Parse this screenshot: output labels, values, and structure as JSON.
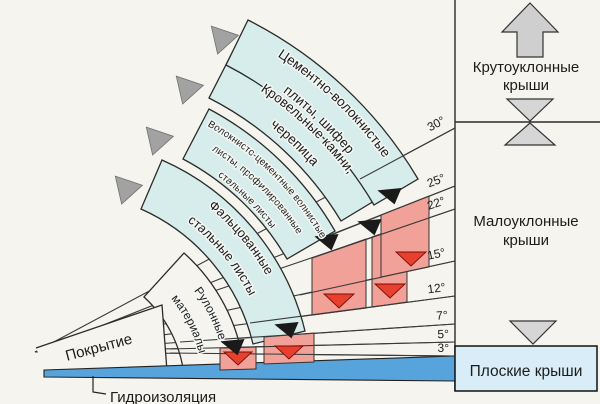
{
  "diagram_title": "Roof slope ranges by roofing material",
  "bands": {
    "cement_fiber": {
      "line1": "Цементно-волокнистые",
      "line2": "плиты, шифер"
    },
    "roof_tiles": {
      "line1": "Кровельные камни,",
      "line2": "черепица"
    },
    "corrugated": {
      "line1": "Волокнисто-цементные волнистые",
      "line2": "листы, профилированные",
      "line3": "стальные листы"
    },
    "seamed": {
      "line1": "Фальцованные",
      "line2": "стальные листы"
    },
    "rolled": {
      "line1": "Рулонные",
      "line2": "материалы"
    }
  },
  "labels": {
    "coating": "Покрытие",
    "waterproofing": "Гидроизоляция"
  },
  "angles": {
    "a30": "30°",
    "a25": "25°",
    "a22": "22°",
    "a15": "15°",
    "a12": "12°",
    "a7": "7°",
    "a5": "5°",
    "a3": "3°"
  },
  "right_panel": {
    "steep_line1": "Крутоуклонные",
    "steep_line2": "крыши",
    "low_line1": "Малоуклонные",
    "low_line2": "крыши",
    "flat": "Плоские крыши"
  },
  "colors": {
    "band": "#d7edeb",
    "white_band": "#f6f4ee",
    "pink": "#f2a198",
    "red": "#e6402f",
    "blue_strip": "#57a4dc",
    "flat_box": "#d8edf8",
    "gray_arrow": "#a2a2a2",
    "panel_arrow": "#cfcfcf"
  }
}
